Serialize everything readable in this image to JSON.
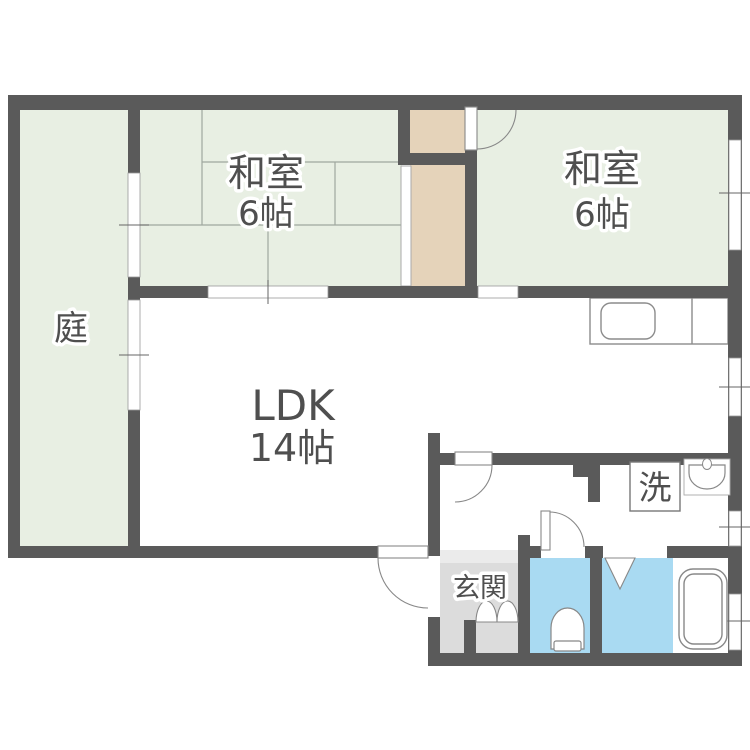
{
  "floorplan": {
    "rooms": {
      "garden": {
        "label": "庭"
      },
      "japanese_room_1": {
        "label": "和室",
        "size": "6帖"
      },
      "japanese_room_2": {
        "label": "和室",
        "size": "6帖"
      },
      "ldk": {
        "label": "LDK",
        "size": "14帖"
      },
      "entrance": {
        "label": "玄関"
      },
      "laundry": {
        "label": "洗"
      }
    },
    "colors": {
      "wall": "#5a5a5a",
      "tatami_and_garden": "#e8efe3",
      "closet": "#e5d3ba",
      "entrance_floor": "#dcdcdc",
      "entrance_step": "#ebebeb",
      "wet_area": "#a9daf2",
      "fixture_stroke": "#888888",
      "tatami_line": "#9fa89f",
      "label_text": "#4f4f4f"
    }
  }
}
